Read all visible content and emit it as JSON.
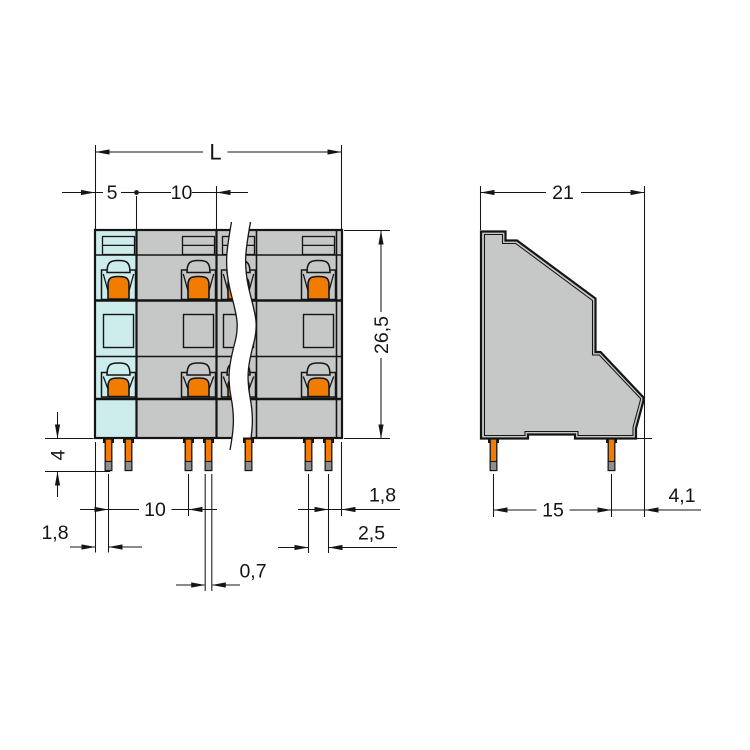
{
  "front_view": {
    "dim_length": "L",
    "dim_edge_to_pole_center": "5",
    "dim_pole_pitch": "10",
    "dim_height": "26,5",
    "dim_pin_length": "4",
    "dim_pin_pitch": "10",
    "dim_edge_to_first_pin": "1,8",
    "dim_pin_width": "0,7",
    "dim_pin_pair_spacing": "2,5",
    "dim_last_pin_to_edge": "1,8"
  },
  "side_view": {
    "dim_depth": "21",
    "dim_pin_row_spacing": "15",
    "dim_pin_to_edge": "4,1"
  },
  "colors": {
    "body_gray": "#c6c7c7",
    "pole_highlight_cyan": "#cdecec",
    "actuator_orange": "#f27c00",
    "pin_tip_gray": "#8f8f8f",
    "line_ink": "#151515",
    "background": "#ffffff"
  }
}
